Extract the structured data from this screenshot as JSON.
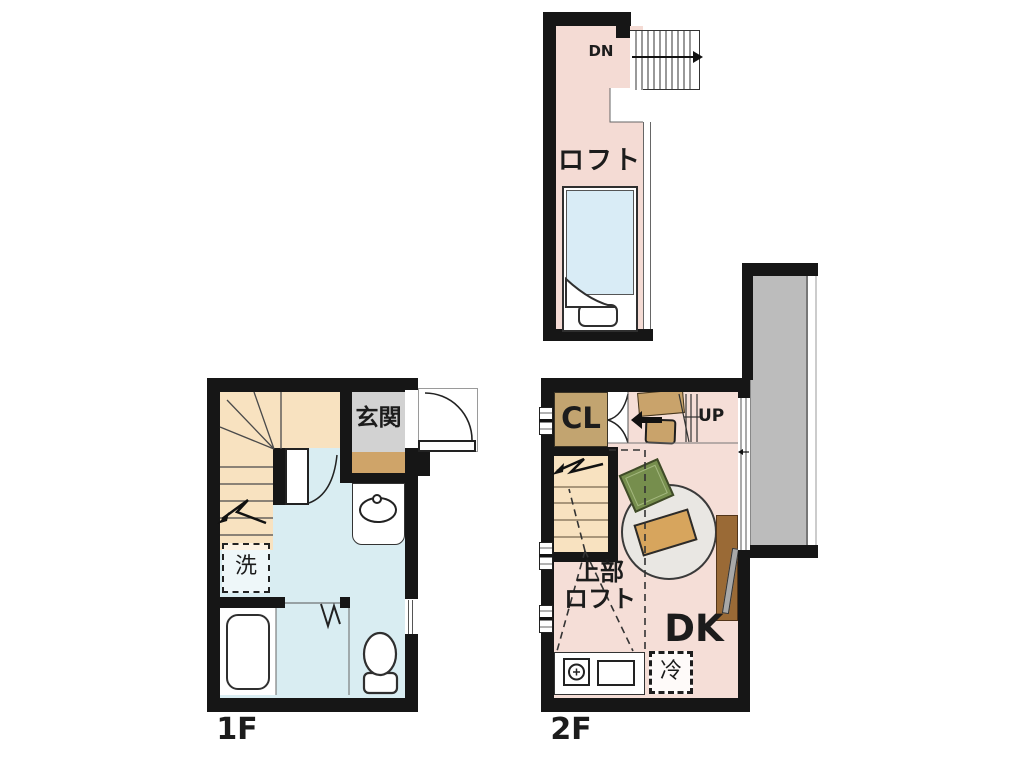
{
  "loft": {
    "label": "ロフト",
    "stair_label": "DN"
  },
  "floor1": {
    "label": "1F",
    "entrance": "玄関",
    "washing_machine": "洗"
  },
  "floor2": {
    "label": "2F",
    "closet": "CL",
    "stair_label": "UP",
    "upper_loft_line1": "上部",
    "upper_loft_line2": "ロフト",
    "dining_kitchen": "DK",
    "refrigerator": "冷"
  },
  "colors": {
    "wall": "#161616",
    "loft_floor": "#f4dbd4",
    "floor1_floor": "#d9edf2",
    "floor2_floor": "#f5ded7",
    "stair": "#f8e2c0",
    "entrance_hall": "#d2d2d2",
    "entrance_step": "#cfa469",
    "closet": "#c2a470",
    "balcony": "#bcbcbc",
    "bed_mattress": "#d9ecf6",
    "rug": "#e9e7e3",
    "low_table": "#d7a55d",
    "floor_cushion": "#768e4d",
    "tv_board": "#9a6a36"
  }
}
